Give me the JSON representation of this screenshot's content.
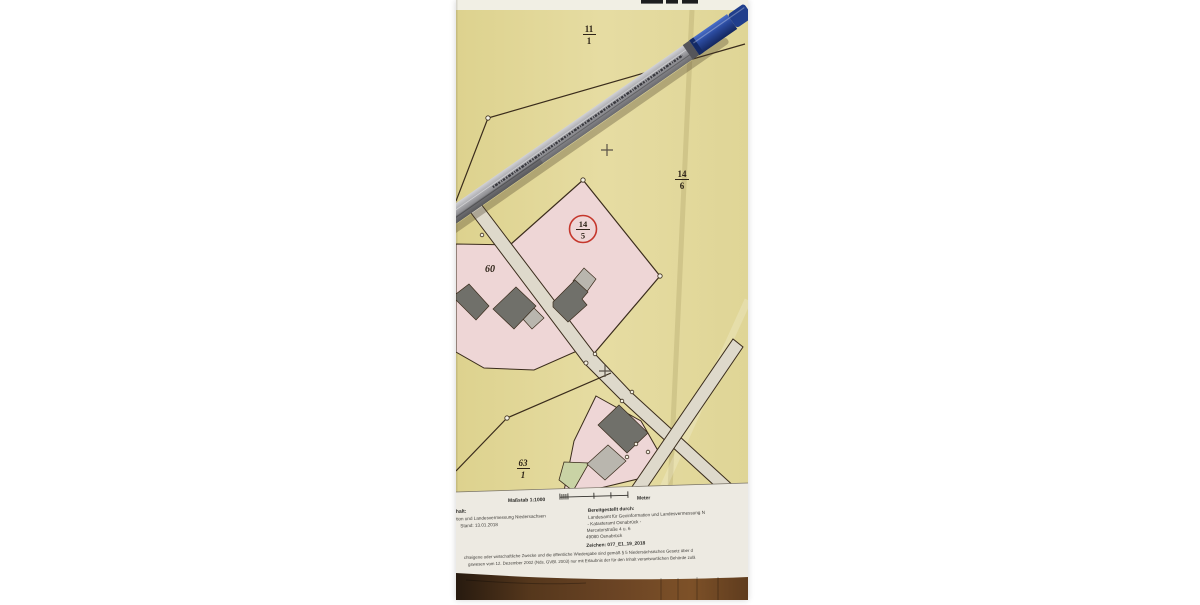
{
  "photo_description": "Photograph of a German cadastral map excerpt (Liegenschaftskarte) lying on a wooden table with a silver-blue pen placed diagonally across it",
  "map": {
    "parcel_labels": {
      "p11_1": {
        "num": "11",
        "den": "1"
      },
      "p14_6": {
        "num": "14",
        "den": "6"
      },
      "p14_5": {
        "num": "14",
        "den": "5"
      },
      "p60": "60",
      "p63_1": {
        "num": "63",
        "den": "1"
      }
    },
    "scale_label": "Maßstab 1:1000",
    "scale_unit": "Meter",
    "footer": {
      "left_partial_line1": "halt:",
      "left_partial_line2": "tion und Landesvermessung Niedersachsen",
      "left_stand": "Stand: 13.01.2018",
      "provided_by_heading": "Bereitgestellt durch:",
      "provider_line1": "Landesamt für Geoinformation und Landesvermessung N",
      "provider_line2": "- Katasteramt Osnabrück -",
      "provider_line3": "Mercatorstraße 4 u. 6",
      "provider_line4": "49080 Osnabrück",
      "reference": "Zeichen:  077_E1_19_2018",
      "disclaimer_line1": "chteigene oder wirtschaftliche Zwecke und die öffentliche Wiedergabe sind gemäß § 5 Niedersächsisches Gesetz über d",
      "disclaimer_line2": "gswesen vom 12. Dezember 2002 (Nds. GVBl. 2003) nur mit Erlaubnis der für den Inhalt verantwortlichen Behörde zulä"
    }
  },
  "colors": {
    "paper_yellow": "#e3d99b",
    "paper_white": "#f1efe4",
    "parcel_pink": "#eed6d6",
    "road": "#ded9cb",
    "building_dark": "#70706a",
    "building_light": "#b9b6ae",
    "green_area": "#c9d3a5",
    "boundary_line": "#3a2c1c",
    "highlight_circle_red": "#c5372c",
    "pen_blue": "#2a4a9e",
    "wood_brown": "#6b4424"
  }
}
